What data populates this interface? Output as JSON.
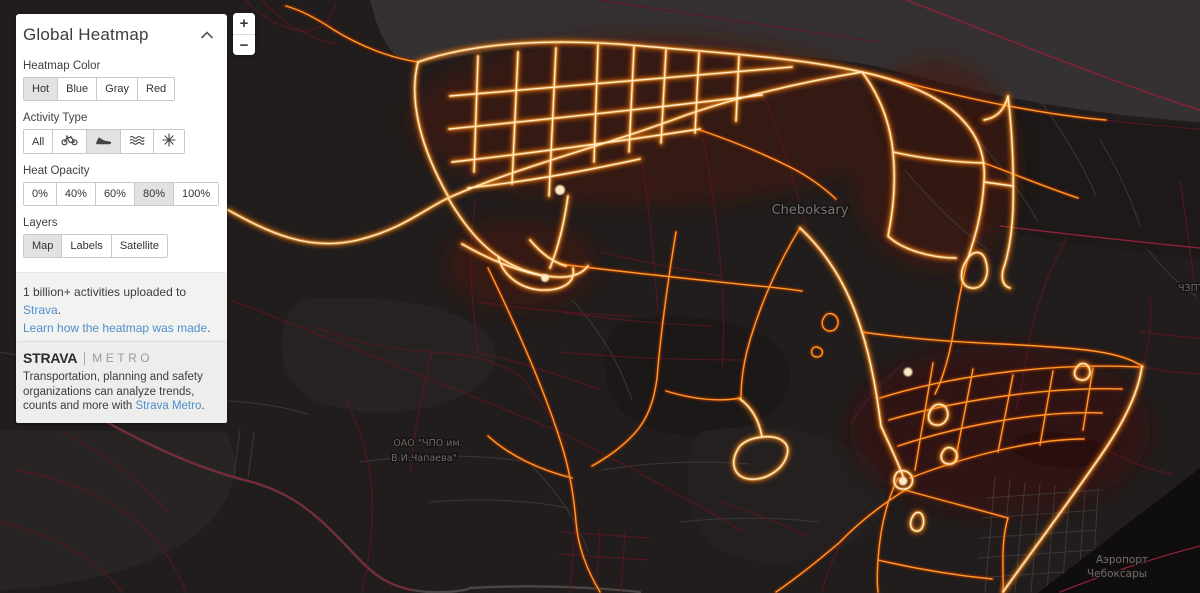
{
  "panel": {
    "title": "Global Heatmap",
    "heatmap_color": {
      "label": "Heatmap Color",
      "options": [
        "Hot",
        "Blue",
        "Gray",
        "Red"
      ],
      "selected": "Hot"
    },
    "activity_type": {
      "label": "Activity Type",
      "options": [
        "All",
        "Ride",
        "Run",
        "Water sports",
        "Winter sports"
      ],
      "selected": "Run"
    },
    "heat_opacity": {
      "label": "Heat Opacity",
      "options": [
        "0%",
        "40%",
        "60%",
        "80%",
        "100%"
      ],
      "selected": "80%"
    },
    "layers": {
      "label": "Layers",
      "options": [
        "Map",
        "Labels",
        "Satellite"
      ],
      "selected": "Map"
    },
    "footer": {
      "text_before_link": "1 billion+ activities uploaded to ",
      "link1": "Strava",
      "after_link1": ".",
      "link2": "Learn how the heatmap was made",
      "after_link2": "."
    }
  },
  "metro_card": {
    "brand": "STRAVA",
    "product": "METRO",
    "text_before_link": "Transportation, planning and safety organizations can analyze trends, counts and more with ",
    "link": "Strava Metro",
    "after_link": "."
  },
  "zoom_control": {
    "zoom_in": "+",
    "zoom_out": "−"
  },
  "map": {
    "labels": {
      "city": "Cheboksary",
      "factory_line1": "ОАО \"ЧПО им.",
      "factory_line2": "В.И.Чапаева\"",
      "airport_line1": "Аэропорт",
      "airport_line2": "Чебоксары",
      "right_edge": "ЧЗПТ"
    },
    "colors": {
      "background": "#211d1c",
      "water": "#353132",
      "heat_core": "#fff3dc",
      "heat_mid": "#ffb84d",
      "heat_glow": "#ff7800",
      "heat_dim": "#5d1527",
      "link_blue": "#4e8fcc"
    }
  }
}
